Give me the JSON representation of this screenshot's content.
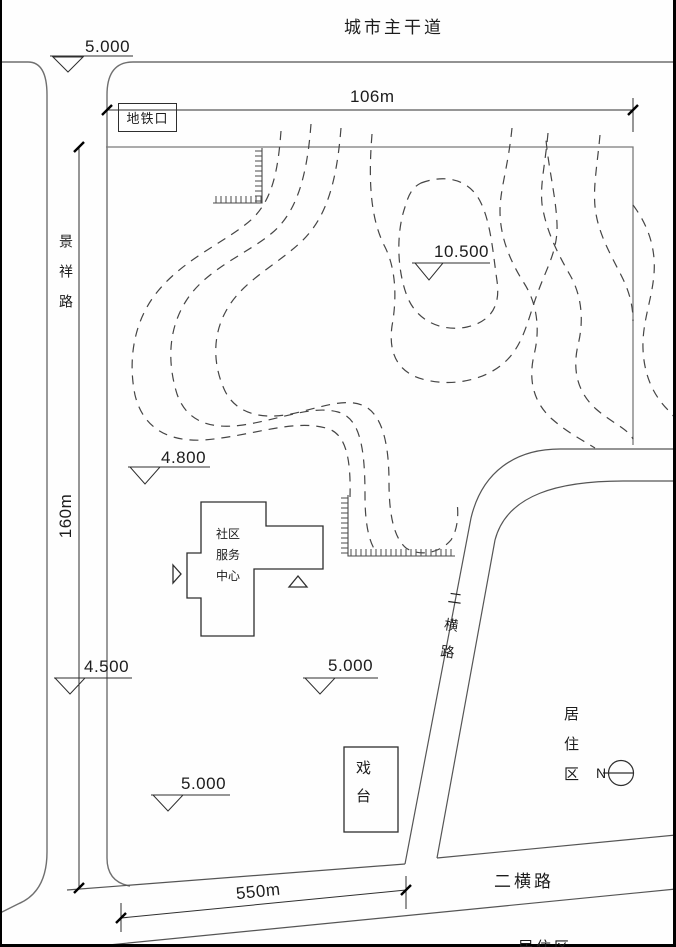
{
  "frame": {
    "main_road_label": "城市主干道"
  },
  "dims": {
    "top": "106m",
    "left": "160m",
    "bottom": "550m"
  },
  "elev": {
    "top_left": "5.000",
    "peak": "10.500",
    "west": "4.800",
    "southwest": "4.500",
    "center": "5.000",
    "south": "5.000"
  },
  "roads": {
    "west_vertical": "景祥路",
    "middle_cross": "二横路",
    "bottom_cross": "二横路"
  },
  "buildings": {
    "metro": "地铁口",
    "community_center": "社区服务中心",
    "stage": "戏台"
  },
  "areas": {
    "residential_east": "居住区",
    "residential_south": "居住区"
  },
  "compass": {
    "north": "N"
  }
}
